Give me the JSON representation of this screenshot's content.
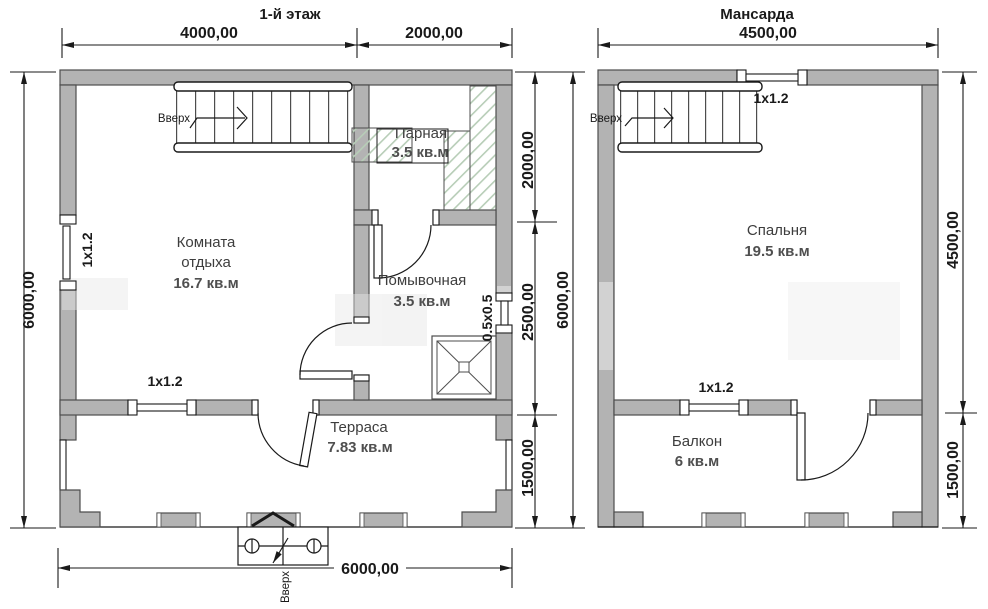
{
  "floor1": {
    "title": "1-й этаж",
    "dim_top_left": "4000,00",
    "dim_top_right": "2000,00",
    "dim_left_total": "6000,00",
    "dim_bottom_total": "6000,00",
    "dim_right_seg1": "2000,00",
    "dim_right_seg2": "2500,00",
    "dim_right_seg3": "1500,00",
    "dim_right_total": "6000,00",
    "rooms": {
      "rest": {
        "name_line1": "Комната",
        "name_line2": "отдыха",
        "area": "16.7 кв.м"
      },
      "steam": {
        "name": "Парная",
        "area": "3.5 кв.м"
      },
      "wash": {
        "name": "Помывочная",
        "area": "3.5 кв.м"
      },
      "terrace": {
        "name": "Терраса",
        "area": "7.83 кв.м"
      }
    },
    "windows": {
      "left_label": "1х1.2",
      "bottom_label": "1х1.2",
      "right_label": "0.5х0.5"
    },
    "stairs_up_label": "Вверх",
    "entrance_up_label": "Вверх"
  },
  "attic": {
    "title": "Мансарда",
    "dim_top": "4500,00",
    "dim_right_seg1": "4500,00",
    "dim_right_seg2": "1500,00",
    "rooms": {
      "bedroom": {
        "name": "Спальня",
        "area": "19.5 кв.м"
      },
      "balcony": {
        "name": "Балкон",
        "area": "6 кв.м"
      }
    },
    "windows": {
      "top_label": "1х1.2",
      "middle_label": "1х1.2"
    },
    "stairs_up_label": "Вверх"
  },
  "colors": {
    "wall_fill": "#b3b3b3",
    "line": "#1a1a1a",
    "hatch_green": "#b7cdb7"
  }
}
